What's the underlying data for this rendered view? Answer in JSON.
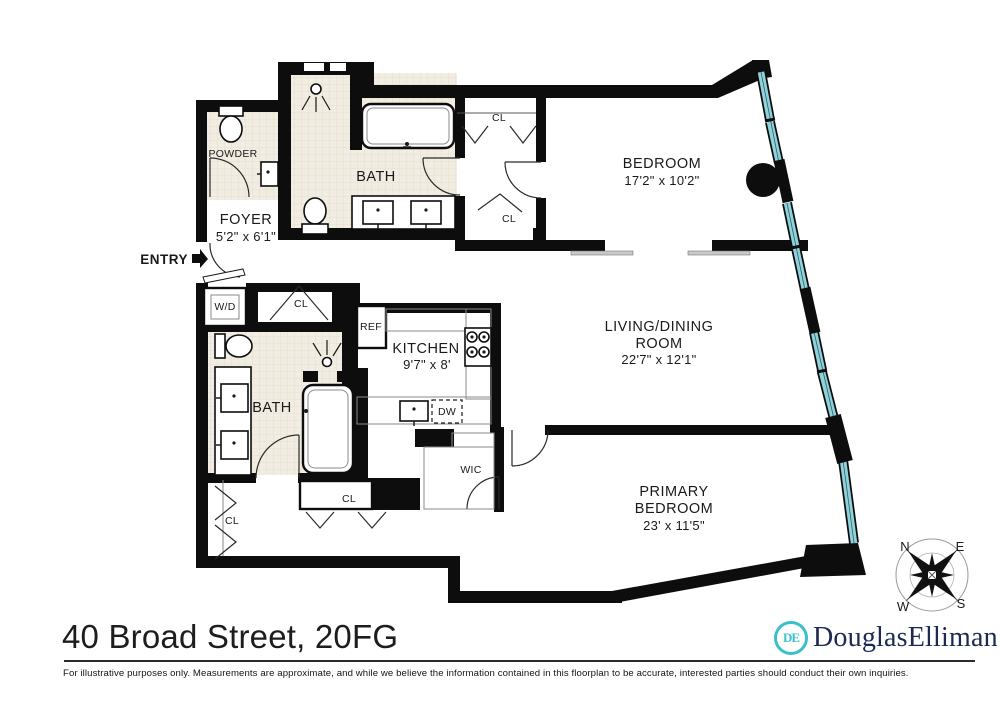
{
  "title": "40 Broad Street, 20FG",
  "disclaimer": "For illustrative purposes only.  Measurements are approximate, and while we believe the information contained in this floorplan to be accurate, interested parties should conduct their own inquiries.",
  "branding": {
    "monogram": "DE",
    "name": "DouglasElliman"
  },
  "compass": {
    "north": "N",
    "east": "E",
    "south": "S",
    "west": "W"
  },
  "entry_label": "ENTRY",
  "rooms": {
    "foyer": {
      "name": "FOYER",
      "dims": "5'2\" x 6'1\""
    },
    "powder": {
      "name": "POWDER"
    },
    "bath_upper": {
      "name": "BATH"
    },
    "bath_lower": {
      "name": "BATH"
    },
    "bedroom": {
      "name": "BEDROOM",
      "dims": "17'2\" x 10'2\""
    },
    "living": {
      "line1": "LIVING/DINING",
      "line2": "ROOM",
      "dims": "22'7\" x 12'1\""
    },
    "kitchen": {
      "name": "KITCHEN",
      "dims": "9'7\" x 8'"
    },
    "primary": {
      "line1": "PRIMARY",
      "line2": "BEDROOM",
      "dims": "23' x 11'5\""
    },
    "wic": {
      "name": "WIC"
    }
  },
  "fixtures": {
    "washer_dryer": "W/D",
    "refrigerator": "REF",
    "dishwasher": "DW"
  },
  "closets": {
    "bedroom_hall_upper": "CL",
    "bedroom_hall_lower": "CL",
    "foyer": "CL",
    "lower_hall_horizontal": "CL",
    "lower_hall_vertical": "CL"
  },
  "colors": {
    "wall": "#0d0d0d",
    "window_glass": "#8fd2da",
    "bath_floor": "#f2ede3",
    "bath_floor_line": "#e3dbc9",
    "brand_teal": "#3bbfcb",
    "brand_navy": "#1c2951",
    "ink": "#1a1a1a",
    "sill_gray": "#c9c9c9"
  }
}
